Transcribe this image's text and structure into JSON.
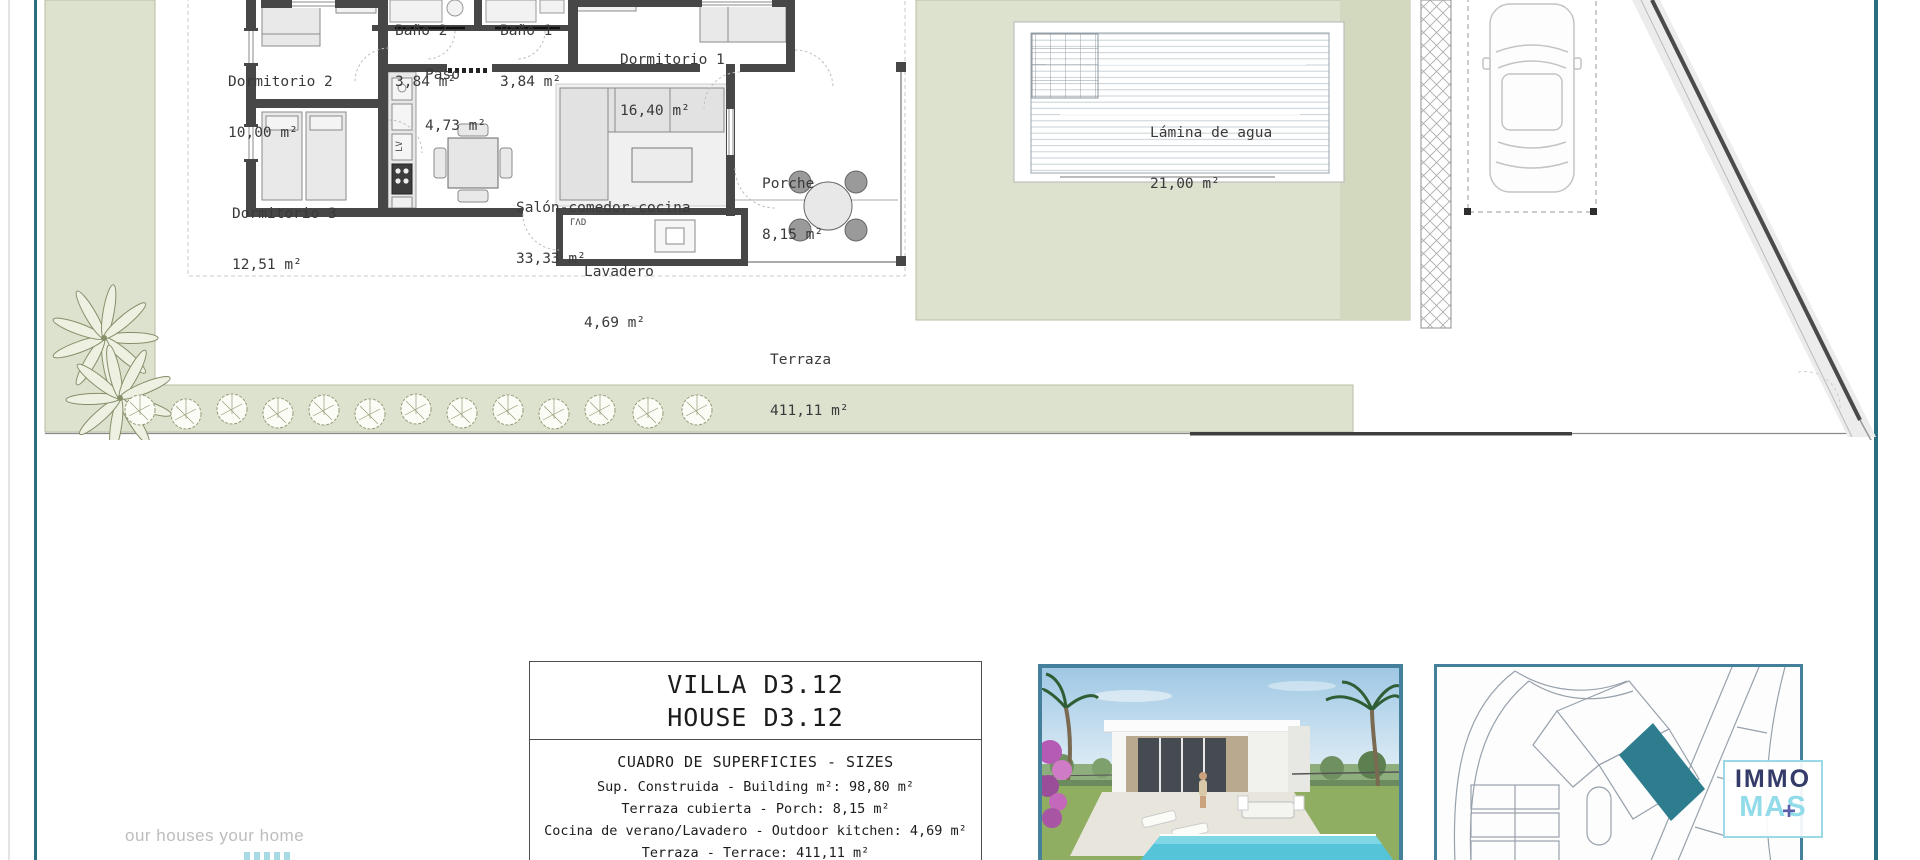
{
  "plan": {
    "rooms": [
      {
        "id": "bano2",
        "name": "Baño 2",
        "area": "3,84 m²"
      },
      {
        "id": "bano1",
        "name": "Baño 1",
        "area": "3,84 m²"
      },
      {
        "id": "dorm2",
        "name": "Dormitorio 2",
        "area": "10,00 m²"
      },
      {
        "id": "paso",
        "name": "Paso",
        "area": "4,73 m²"
      },
      {
        "id": "dorm1",
        "name": "Dormitorio 1",
        "area": "16,40 m²"
      },
      {
        "id": "dorm3",
        "name": "Dormitorio 3",
        "area": "12,51 m²"
      },
      {
        "id": "salon",
        "name": "Salón-comedor-cocina",
        "area": "33,33 m²"
      },
      {
        "id": "porche",
        "name": "Porche",
        "area": "8,15 m²"
      },
      {
        "id": "lavadero",
        "name": "Lavadero",
        "area": "4,69 m²"
      }
    ],
    "pool": {
      "name": "Lámina de agua",
      "area": "21,00 m²"
    },
    "terrace": {
      "name": "Terraza",
      "area": "411,11 m²"
    },
    "marks": {
      "lavadero": "ΓΛD",
      "dishwasher": "LV"
    }
  },
  "title_block": {
    "line1": "VILLA D3.12",
    "line2": "HOUSE D3.12",
    "table_title": "CUADRO DE SUPERFICIES  - SIZES",
    "rows": [
      "Sup. Construida  - Building m²: 98,80 m²",
      "Terraza cubierta  - Porch: 8,15 m²",
      "Cocina de verano/Lavadero  - Outdoor kitchen: 4,69 m²",
      "Terraza - Terrace: 411,11 m²"
    ]
  },
  "branding": {
    "slogan": "our houses your home",
    "logo_top": "IMMO",
    "logo_bottom": "MAS",
    "logo_plus": "+"
  },
  "colors": {
    "accent_teal": "#2a6d7e",
    "box_border_blue": "#44809c",
    "parcel_highlight": "#2e7d8f",
    "logo_navy": "#343b68",
    "logo_cyan": "#92dcea",
    "garden_green": "#dde2cf"
  }
}
